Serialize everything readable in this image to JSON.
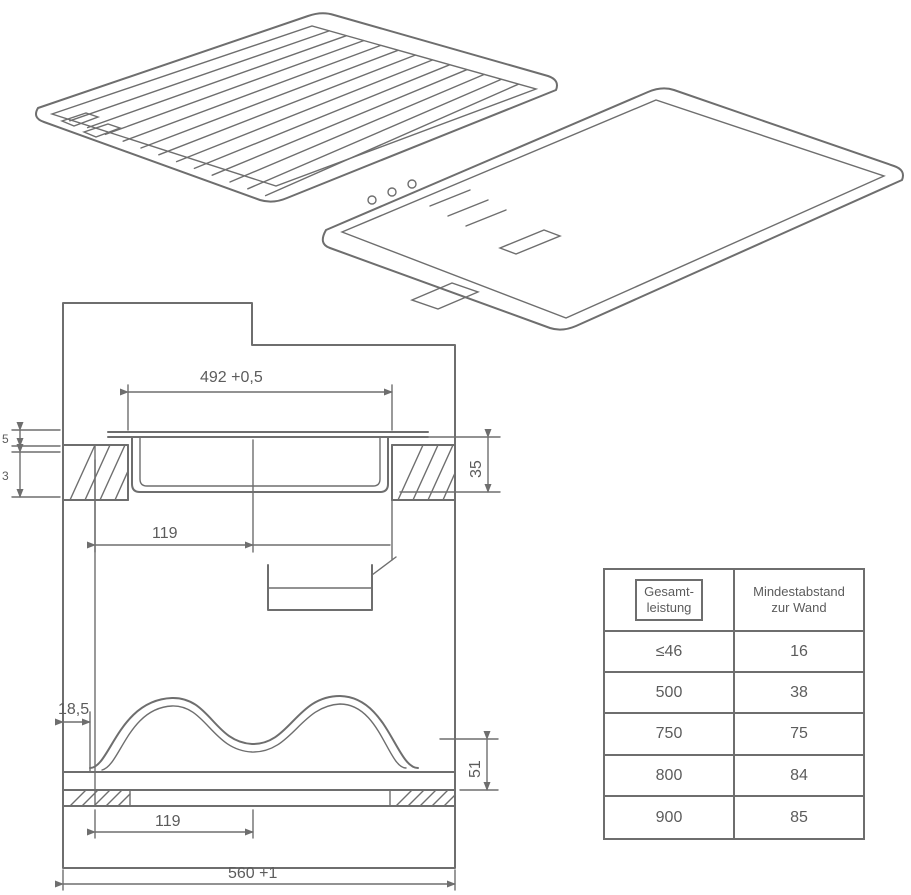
{
  "drawing": {
    "dimensions": {
      "cutout_width": "492 +0,5",
      "offset_top": "119",
      "offset_bottom": "119",
      "duct_offset": "18,5",
      "right_upper": "35",
      "right_lower": "51",
      "overall_width": "560 +1",
      "left_small_upper": "5",
      "left_small_lower": "3"
    }
  },
  "table": {
    "headers": [
      "Gesamt-\nleistung",
      "Mindestabstand\nzur Wand"
    ],
    "rows": [
      [
        "≤46",
        "16"
      ],
      [
        "500",
        "38"
      ],
      [
        "750",
        "75"
      ],
      [
        "800",
        "84"
      ],
      [
        "900",
        "85"
      ]
    ]
  }
}
